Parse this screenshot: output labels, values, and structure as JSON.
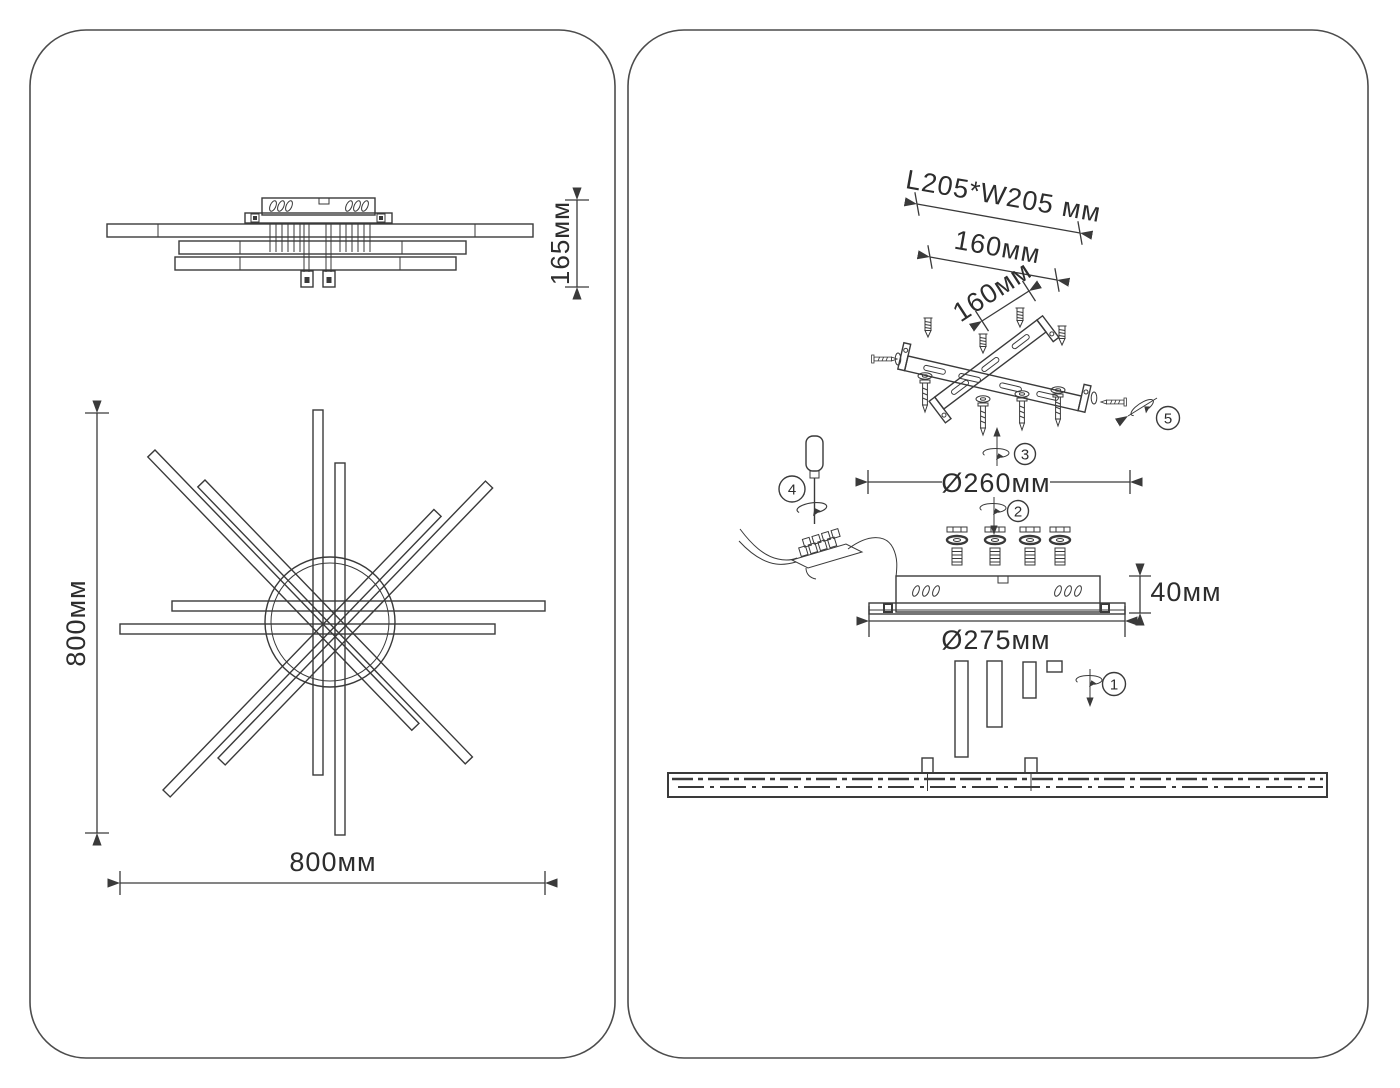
{
  "document": {
    "type": "lighting-fixture-installation-drawing",
    "colors": {
      "background": "#ffffff",
      "line": "#3a3a3a",
      "panel_border": "#4c4c4c",
      "text": "#2d2d2d"
    }
  },
  "left_panel": {
    "side_view": {
      "height_dim": "165мм"
    },
    "top_view": {
      "height_dim": "800мм",
      "width_dim": "800мм"
    }
  },
  "right_panel": {
    "mounting_bracket": {
      "outer_dim": "L205*W205 мм",
      "hole_spacing_dim": "160мм",
      "hole_spacing_dim_2": "160мм"
    },
    "canopy": {
      "bolt_circle_dim": "Ø260мм",
      "height_dim": "40мм",
      "diameter_dim": "Ø275мм"
    },
    "steps": {
      "s1": "1",
      "s2": "2",
      "s3": "3",
      "s4": "4",
      "s5": "5"
    }
  }
}
